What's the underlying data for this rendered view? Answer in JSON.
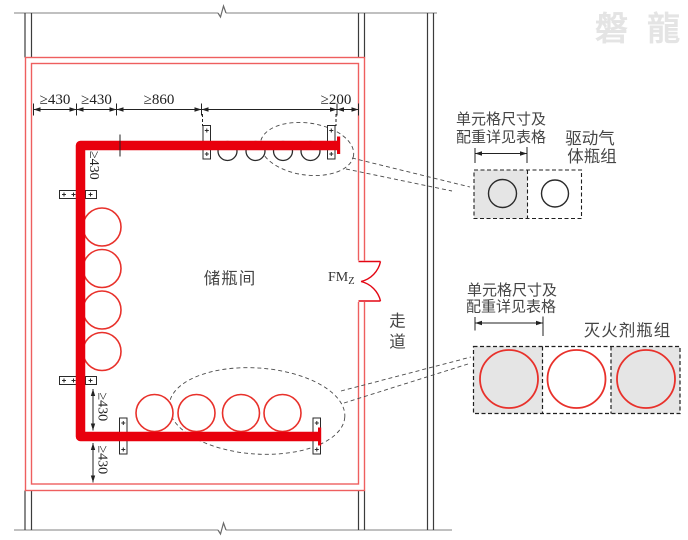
{
  "watermark": "磐 龍",
  "room": {
    "label": "储瓶间"
  },
  "corridor": {
    "line1": "走",
    "line2": "道"
  },
  "door": {
    "code": "FM",
    "subscript": "Z"
  },
  "dimensions": {
    "top": [
      "≥430",
      "≥430",
      "≥860",
      "≥200"
    ],
    "left_upper": "≥430",
    "bottom_left_upper": "≥430",
    "bottom_left_lower": "≥430"
  },
  "callouts": {
    "cell_note_line1": "单元格尺寸及",
    "cell_note_line2": "配重详见表格",
    "driving_gas_label_line1": "驱动气",
    "driving_gas_label_line2": "体瓶组",
    "agent_label": "灭火剂瓶组"
  },
  "colors": {
    "pipe_red": "#e8000d",
    "bottle_red": "#e8312b",
    "wall_red": "#ee5f5f",
    "cell_gray": "#e5e5e5",
    "line_dark": "#222222",
    "text_dark": "#454545",
    "watermark_gray": "#e4e4e4"
  }
}
